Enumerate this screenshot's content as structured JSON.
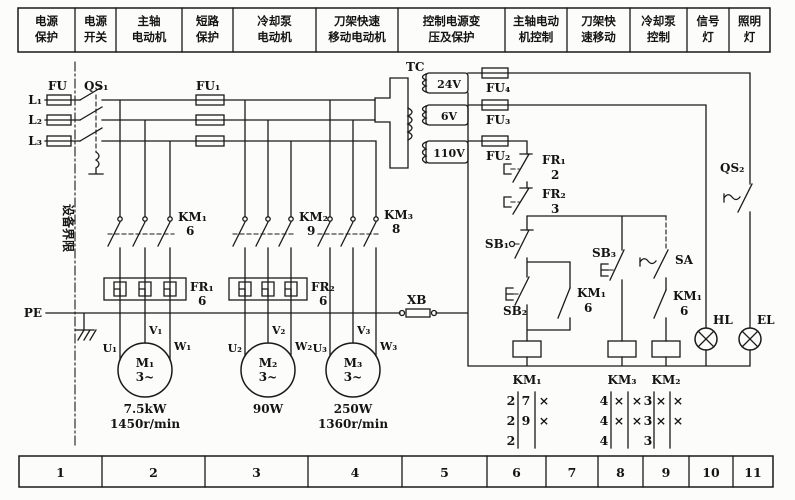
{
  "header": {
    "cells": [
      {
        "line1": "电源",
        "line2": "保护"
      },
      {
        "line1": "电源",
        "line2": "开关"
      },
      {
        "line1": "主轴",
        "line2": "电动机"
      },
      {
        "line1": "短路",
        "line2": "保护"
      },
      {
        "line1": "冷却泵",
        "line2": "电动机"
      },
      {
        "line1": "刀架快速",
        "line2": "移动电动机"
      },
      {
        "line1": "控制电源变",
        "line2": "压及保护"
      },
      {
        "line1": "主轴电动",
        "line2": "机控制"
      },
      {
        "line1": "刀架快",
        "line2": "速移动"
      },
      {
        "line1": "冷却泵",
        "line2": "控制"
      },
      {
        "line1": "信号",
        "line2": "灯"
      },
      {
        "line1": "照明",
        "line2": "灯"
      }
    ]
  },
  "footer": {
    "cells": [
      "1",
      "2",
      "3",
      "4",
      "5",
      "6",
      "7",
      "8",
      "9",
      "10",
      "11"
    ]
  },
  "power": {
    "l1": "L₁",
    "l2": "L₂",
    "l3": "L₃",
    "fu": "FU",
    "qs1": "QS₁",
    "fu1": "FU₁",
    "boundary": "设备界限",
    "pe": "PE",
    "xb": "XB",
    "km1": "KM₁",
    "km1_n": "6",
    "km2": "KM₂",
    "km2_n": "9",
    "km3": "KM₃",
    "km3_n": "8",
    "fr1": "FR₁",
    "fr1_n": "6",
    "fr2": "FR₂",
    "fr2_n": "6"
  },
  "motors": {
    "m1": {
      "name": "M₁",
      "phase": "3~",
      "u": "U₁",
      "v": "V₁",
      "w": "W₁",
      "power": "7.5kW",
      "speed": "1450r/min"
    },
    "m2": {
      "name": "M₂",
      "phase": "3~",
      "u": "U₂",
      "v": "V₂",
      "w": "W₂",
      "power": "90W",
      "speed": ""
    },
    "m3": {
      "name": "M₃",
      "phase": "3~",
      "u": "U₃",
      "v": "V₃",
      "w": "W₃",
      "power": "250W",
      "speed": "1360r/min"
    }
  },
  "transformer": {
    "tc": "TC",
    "v24": "24V",
    "v6": "6V",
    "v110": "110V",
    "fu4": "FU₄",
    "fu3": "FU₃",
    "fu2": "FU₂"
  },
  "control": {
    "fr1": "FR₁",
    "fr1_n": "2",
    "fr2": "FR₂",
    "fr2_n": "3",
    "sb1": "SB₁",
    "sb2": "SB₂",
    "sb3": "SB₃",
    "sa": "SA",
    "km1aux": "KM₁",
    "km1aux_n": "6",
    "km1aux2": "KM₁",
    "km1aux2_n": "6",
    "qs2": "QS₂",
    "hl": "HL",
    "el": "EL",
    "coil_km1": "KM₁",
    "coil_km3": "KM₃",
    "coil_km2": "KM₂"
  },
  "tables": {
    "km1": {
      "title": "KM₁",
      "rows": [
        [
          "2",
          "7",
          "×"
        ],
        [
          "2",
          "9",
          "×"
        ],
        [
          "2",
          "",
          ""
        ]
      ]
    },
    "km3": {
      "title": "KM₃",
      "rows": [
        [
          "4",
          "×",
          "×"
        ],
        [
          "4",
          "×",
          "×"
        ],
        [
          "4",
          "",
          ""
        ]
      ]
    },
    "km2": {
      "title": "KM₂",
      "rows": [
        [
          "3",
          "×",
          "×"
        ],
        [
          "3",
          "×",
          "×"
        ],
        [
          "3",
          "",
          ""
        ]
      ]
    }
  }
}
